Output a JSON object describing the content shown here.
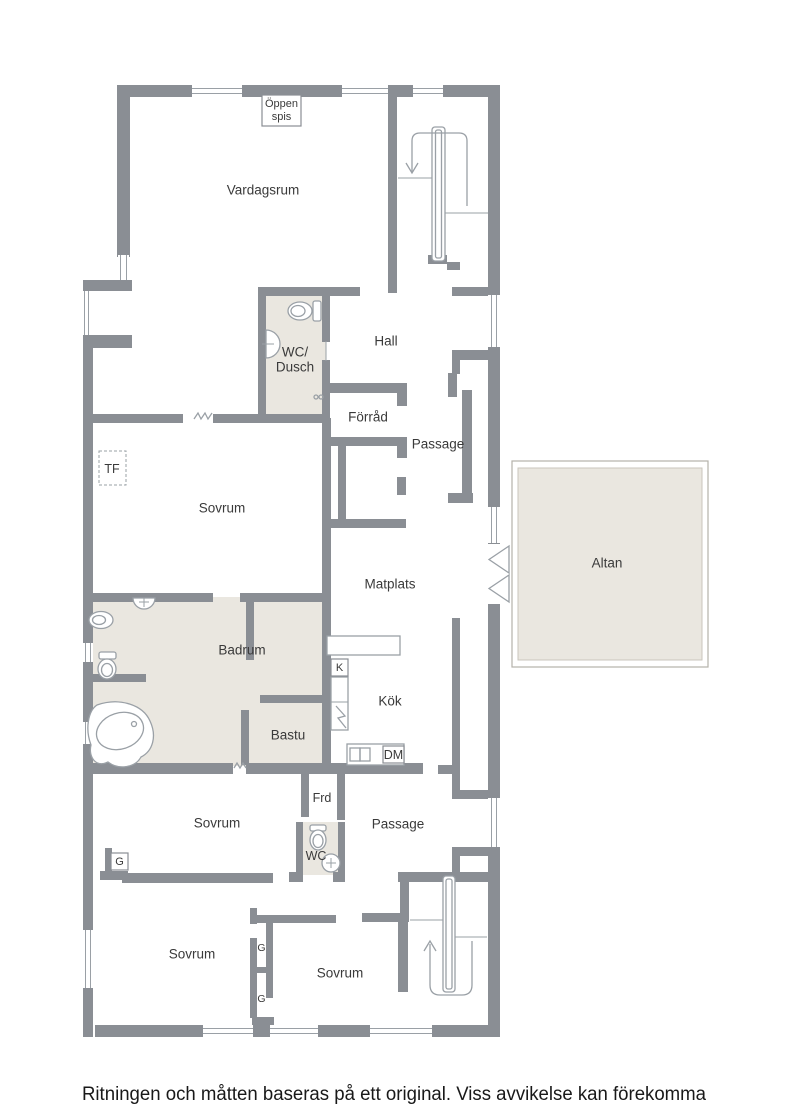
{
  "colors": {
    "wall": "#8a8e94",
    "thin_line": "#9aa0a6",
    "wet_room_fill": "#eae7e0",
    "altan_fill": "#eae7e0",
    "label_text": "#3a3a3a",
    "disclaimer_text": "#191919",
    "background": "#ffffff"
  },
  "labels": {
    "oppen_spis_1": "Öppen",
    "oppen_spis_2": "spis",
    "vardagsrum": "Vardagsrum",
    "wc_dusch_1": "WC/",
    "wc_dusch_2": "Dusch",
    "hall": "Hall",
    "forrad": "Förråd",
    "passage_upper": "Passage",
    "tf": "TF",
    "sovrum_master": "Sovrum",
    "matplats": "Matplats",
    "altan": "Altan",
    "badrum": "Badrum",
    "k": "K",
    "kok": "Kök",
    "bastu": "Bastu",
    "dm": "DM",
    "frd": "Frd",
    "passage_lower": "Passage",
    "wc": "WC",
    "sovrum_2": "Sovrum",
    "g_1": "G",
    "sovrum_3": "Sovrum",
    "g_2": "G",
    "g_3": "G",
    "sovrum_4": "Sovrum"
  },
  "disclaimer": "Ritningen och måtten baseras på ett original. Viss avvikelse kan förekomma"
}
